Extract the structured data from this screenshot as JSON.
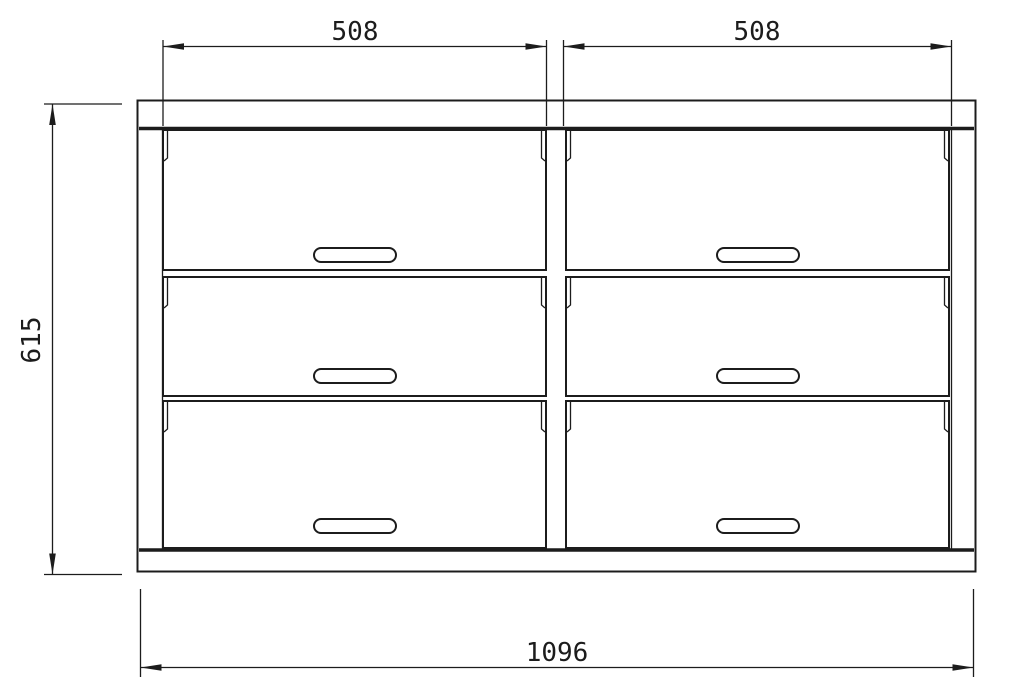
{
  "diagram": {
    "description": "Technical dimension drawing of a six-drawer double dresser, front elevation",
    "colors": {
      "line": "#1c1c1c",
      "background": "#ffffff"
    },
    "cabinet": {
      "columns": 2,
      "rows": 3,
      "drawer_count": 6
    },
    "dimensions": {
      "top_left_width": "508",
      "top_right_width": "508",
      "left_height": "615",
      "bottom_total_width": "1096"
    }
  }
}
